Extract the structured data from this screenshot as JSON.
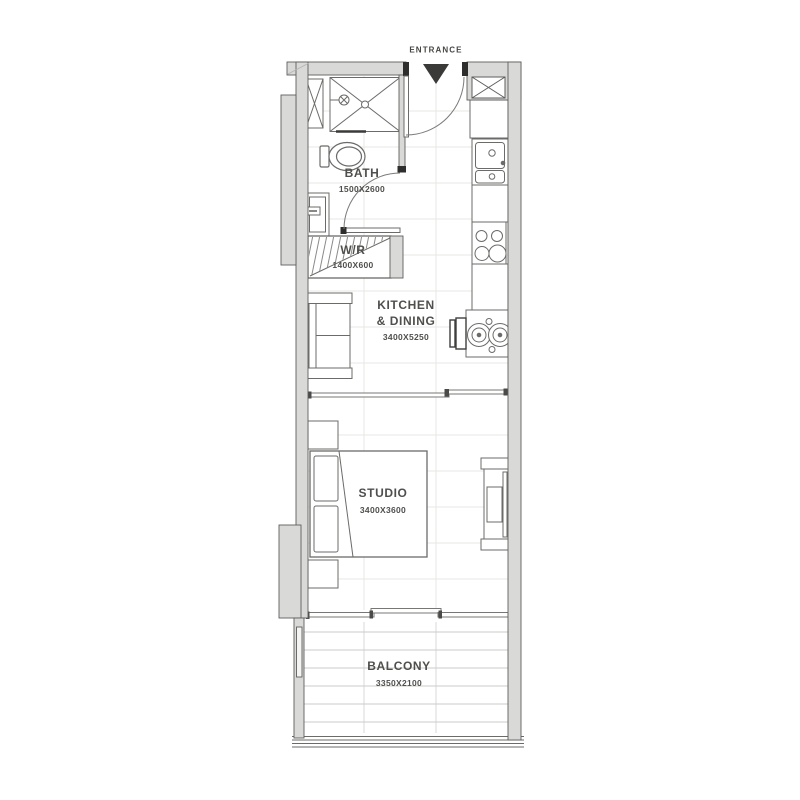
{
  "entrance": {
    "label": "ENTRANCE"
  },
  "rooms": {
    "bath": {
      "name": "BATH",
      "size": "1500X2600"
    },
    "wr": {
      "name": "W/R",
      "size": "1400X600"
    },
    "kitchen": {
      "name_line1": "KITCHEN",
      "name_line2": "& DINING",
      "size": "3400X5250"
    },
    "studio": {
      "name": "STUDIO",
      "size": "3400X3600"
    },
    "balcony": {
      "name": "BALCONY",
      "size": "3350X2100"
    }
  },
  "icons": {
    "entrance_arrow": "black triangle pointing down at entry door"
  },
  "fixtures": [
    "shower",
    "toilet",
    "vanity-sink",
    "utility-cabinet",
    "wardrobe-hatch",
    "sofa",
    "kitchen-sink",
    "stove",
    "dining-table",
    "dining-chair",
    "bed",
    "nightstand",
    "tv-unit",
    "balcony-deck",
    "railing"
  ],
  "colors": {
    "background": "#ffffff",
    "wall_fill": "#d9d9d7",
    "wall_outline": "#5e5e5c",
    "furniture_line": "#6b6b69",
    "floor_grid": "#e7e7e5",
    "deck_line": "#cbcbc9",
    "text": "#4f4f4d",
    "black_details": "#2e2e2c"
  }
}
